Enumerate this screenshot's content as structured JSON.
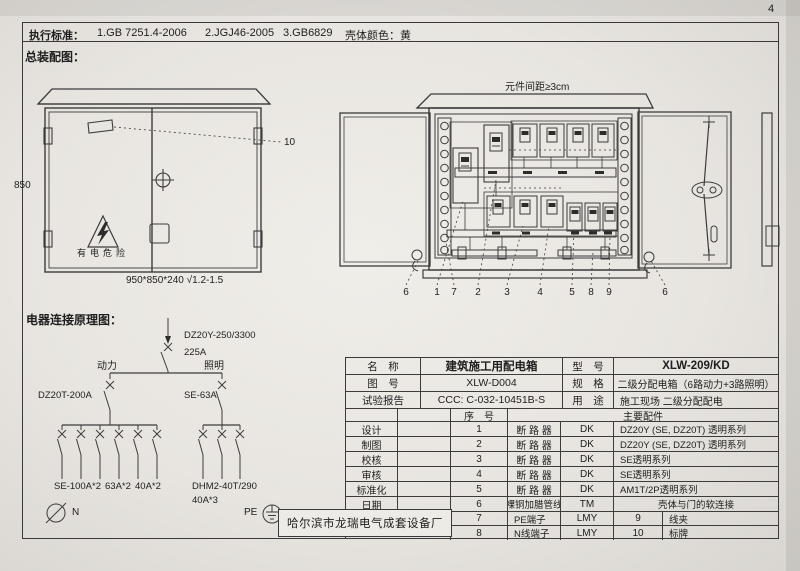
{
  "page_number": "4",
  "header": {
    "exec_label": "执行标准：",
    "standard_1": "1.GB 7251.4-2006",
    "standard_2": "2.JGJ46-2005",
    "standard_3": "3.GB6829",
    "shell_color": "壳体颜色：黄"
  },
  "assembly": {
    "title": "总装配图：",
    "front": {
      "height": "850",
      "size": "950*850*240 √1.2-1.5",
      "warning": "有电危险",
      "callout_10": "10"
    },
    "open": {
      "spacing": "元件间距≥3cm",
      "callouts": [
        "6",
        "1",
        "7",
        "2",
        "3",
        "4",
        "5",
        "8",
        "9",
        "6"
      ]
    }
  },
  "schematic": {
    "title": "电器连接原理图：",
    "main_model": "DZ20Y-250/3300",
    "main_rating": "225A",
    "power": "动力",
    "lighting": "照明",
    "power_breaker": "DZ20T-200A",
    "lighting_breaker": "SE-63A",
    "power_out_1": "SE-100A*2",
    "power_out_2": "63A*2",
    "power_out_3": "40A*2",
    "lighting_out": "DHM2-40T/290",
    "lighting_out_qty": "40A*3",
    "neutral": "N",
    "pe": "PE"
  },
  "titleblock": {
    "info": [
      {
        "l": "名　称",
        "v": "建筑施工用配电箱",
        "l2": "型　号",
        "v2": "XLW-209/KD"
      },
      {
        "l": "图　号",
        "v": "XLW-D004",
        "l2": "规　格",
        "v2": "二级分配电箱（6路动力+3路照明）"
      },
      {
        "l": "试验报告",
        "v": "CCC: C-032-10451B-S",
        "l2": "用　途",
        "v2": "施工现场 二级分配配电"
      }
    ],
    "seq_header": "序　号",
    "parts_header": "主要配件",
    "sign": [
      "设计",
      "制图",
      "校核",
      "审核",
      "标准化",
      "日期"
    ],
    "parts": [
      {
        "no": "1",
        "name": "断 路 器",
        "code": "DK",
        "desc": "DZ20Y (SE, DZ20T) 透明系列"
      },
      {
        "no": "2",
        "name": "断 路 器",
        "code": "DK",
        "desc": "DZ20Y (SE, DZ20T) 透明系列"
      },
      {
        "no": "3",
        "name": "断 路 器",
        "code": "DK",
        "desc": "SE透明系列"
      },
      {
        "no": "4",
        "name": "断 路 器",
        "code": "DK",
        "desc": "SE透明系列"
      },
      {
        "no": "5",
        "name": "断 路 器",
        "code": "DK",
        "desc": "AM1T/2P透明系列"
      },
      {
        "no": "6",
        "name": "裸铜加腊管线",
        "code": "TM",
        "desc": "壳体与门的软连接"
      },
      {
        "no": "7",
        "name": "PE端子",
        "code": "LMY",
        "no2": "9",
        "desc2": "线夹"
      },
      {
        "no": "8",
        "name": "N线端子",
        "code": "LMY",
        "no2": "10",
        "desc2": "标牌"
      }
    ],
    "company": "哈尔滨市龙瑞电气成套设备厂"
  }
}
